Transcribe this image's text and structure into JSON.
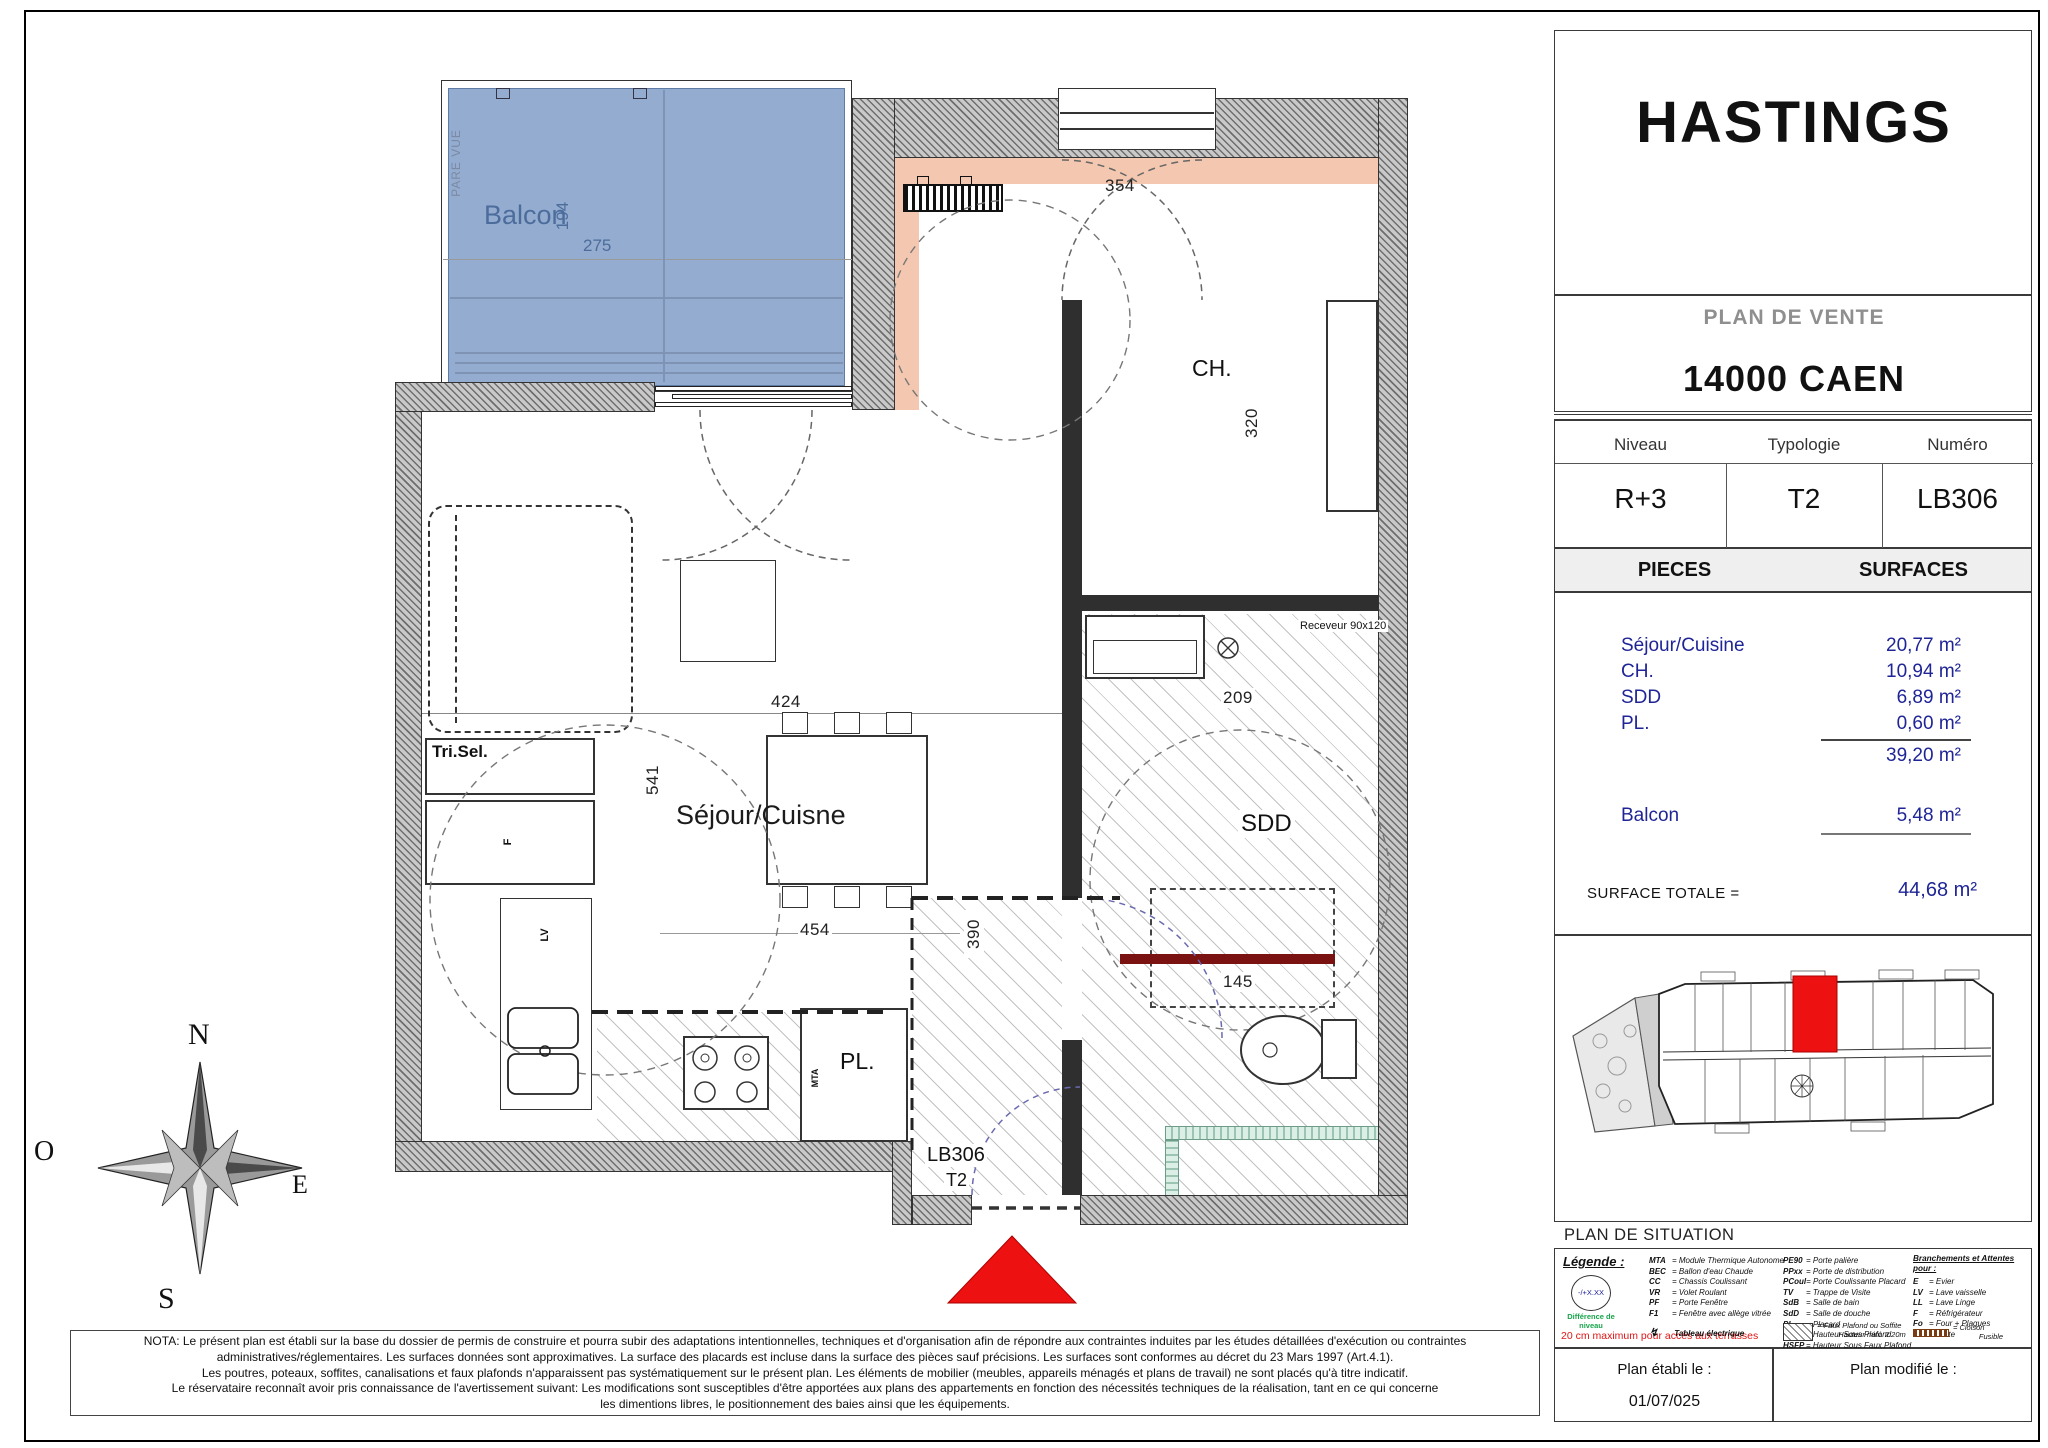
{
  "plan": {
    "balcony": {
      "label": "Balcon",
      "pare_vue": "PARE VUE",
      "dim_width": "275",
      "dim_depth": "194"
    },
    "rooms": {
      "ch": "CH.",
      "sejour": "Séjour/Cuisne",
      "sdd": "SDD",
      "pl": "PL.",
      "tri_sel": "Tri.Sel."
    },
    "dims": {
      "d354": "354",
      "d320": "320",
      "d424": "424",
      "d541": "541",
      "d454": "454",
      "d390": "390",
      "d209": "209",
      "d145": "145"
    },
    "appliances": {
      "f": "F",
      "lv": "LV",
      "mta": "MTA",
      "receveur": "Receveur 90x120"
    },
    "unit": {
      "number": "LB306",
      "type": "T2"
    }
  },
  "compass": {
    "n": "N",
    "o": "O",
    "e": "E",
    "s": "S"
  },
  "panel": {
    "project": "HASTINGS",
    "plan_type": "PLAN DE VENTE",
    "city": "14000 CAEN",
    "unit_table": {
      "niveau_label": "Niveau",
      "typologie_label": "Typologie",
      "numero_label": "Numéro",
      "niveau": "R+3",
      "typologie": "T2",
      "numero": "LB306"
    },
    "surfaces": {
      "pieces_header": "PIECES",
      "surfaces_header": "SURFACES",
      "rows": [
        {
          "label": "Séjour/Cuisine",
          "value": "20,77 m²"
        },
        {
          "label": "CH.",
          "value": "10,94 m²"
        },
        {
          "label": "SDD",
          "value": "6,89 m²"
        },
        {
          "label": "PL.",
          "value": "0,60 m²"
        }
      ],
      "subtotal": "39,20 m²",
      "balcon_label": "Balcon",
      "balcon_value": "5,48 m²",
      "total_label": "SURFACE TOTALE =",
      "total_value": "44,68 m²"
    },
    "situation_title": "PLAN DE SITUATION",
    "legend": {
      "title": "Légende :",
      "level_symbol": "-/+X.XX",
      "level_caption": "Différence de niveau",
      "electrical_glyph": "↯",
      "electrical": "Tableau électrique",
      "col1": [
        {
          "abbr": "MTA",
          "label": "= Module Thermique Autonome"
        },
        {
          "abbr": "BEC",
          "label": "= Ballon d'eau Chaude"
        },
        {
          "abbr": "CC",
          "label": "= Chassis Coulissant"
        },
        {
          "abbr": "VR",
          "label": "= Volet Roulant"
        },
        {
          "abbr": "PF",
          "label": "= Porte Fenêtre"
        },
        {
          "abbr": "F1",
          "label": "= Fenêtre avec allège vitrée"
        }
      ],
      "col2": [
        {
          "abbr": "PE90",
          "label": "= Porte palière"
        },
        {
          "abbr": "PPxx",
          "label": "= Porte de distribution"
        },
        {
          "abbr": "PCoul",
          "label": "= Porte Coulissante Placard"
        },
        {
          "abbr": "TV",
          "label": "= Trappe de Visite"
        },
        {
          "abbr": "SdB",
          "label": "= Salle de bain"
        },
        {
          "abbr": "SdD",
          "label": "= Salle de douche"
        },
        {
          "abbr": "PL",
          "label": "= Placard"
        },
        {
          "abbr": "HSP",
          "label": "= Hauteur Sous Plafond"
        },
        {
          "abbr": "HSFP",
          "label": "= Hauteur Sous Faux Plafond"
        }
      ],
      "col3_title": "Branchements et Attentes pour :",
      "col3": [
        {
          "abbr": "E",
          "label": "= Evier"
        },
        {
          "abbr": "LV",
          "label": "= Lave vaisselle"
        },
        {
          "abbr": "LL",
          "label": "= Lave Linge"
        },
        {
          "abbr": "F",
          "label": "= Réfrigérateur"
        },
        {
          "abbr": "Fo",
          "label": "= Four + Plaques"
        },
        {
          "abbr": "H",
          "label": "= Hotte"
        }
      ],
      "terrace_note": "20 cm maximum pour accès aux terrasses",
      "faux_plafond_1": "= Faux Plafond ou Soffite",
      "faux_plafond_2": "Hauteur mini. 2.20m",
      "cloison_1": "= Cloison",
      "cloison_2": "Fusible"
    },
    "dates": {
      "etabli_label": "Plan établi le :",
      "etabli_value": "01/07/025",
      "modifie_label": "Plan modifié le :"
    }
  },
  "nota": {
    "l1": "NOTA: Le présent plan est établi sur la base du dossier de permis de construire et pourra subir des adaptations intentionnelles, techniques et d'organisation afin de répondre aux contraintes induites par les études détaillées d'exécution ou contraintes",
    "l2": "administratives/réglementaires. Les surfaces données sont approximatives. La surface des placards est incluse dans la surface des pièces sauf précisions. Les surfaces sont conformes au décret du 23 Mars 1997 (Art.4.1).",
    "l3": "Les poutres, poteaux, soffites, canalisations et faux plafonds n'apparaissent pas systématiquement sur le présent plan. Les éléments de mobilier (meubles, appareils ménagés et plans de travail) ne sont placés qu'à titre indicatif.",
    "l4": "Le réservataire reconnaît avoir pris connaissance de l'avertissement suivant: Les modifications sont susceptibles d'être apportées aux plans des appartements en fonction des nécessités techniques de la réalisation, tant en ce qui concerne",
    "l5": "les dimentions libres, le positionnement des baies ainsi que les équipements."
  }
}
